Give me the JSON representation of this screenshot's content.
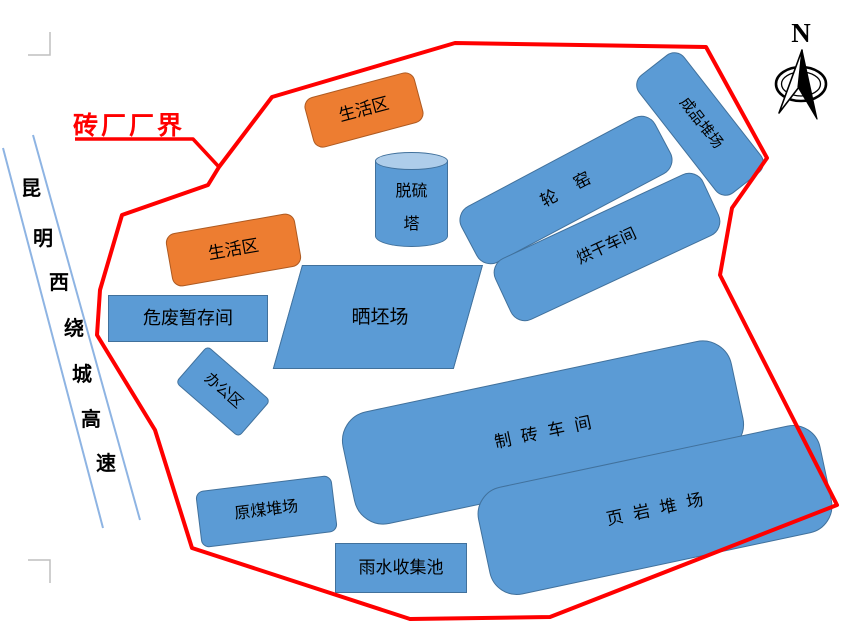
{
  "page": {
    "title_label": "砖厂厂界"
  },
  "compass": {
    "north_label": "N"
  },
  "road": {
    "name": "昆明西绕城高速",
    "chars": [
      "昆",
      "明",
      "西",
      "绕",
      "城",
      "高",
      "速"
    ]
  },
  "areas": {
    "living_area_top": {
      "label": "生活区"
    },
    "living_area_left": {
      "label": "生活区"
    },
    "desulfurization_tower": {
      "line1": "脱硫",
      "line2": "塔"
    },
    "ring_kiln": {
      "label": "轮窑"
    },
    "finished_goods_yard": {
      "label": "成品堆场"
    },
    "drying_workshop": {
      "label": "烘干车间"
    },
    "hazardous_waste_room": {
      "label": "危废暂存间"
    },
    "brick_blank_drying_field": {
      "label": "晒坯场"
    },
    "office_area": {
      "label": "办公区"
    },
    "brick_making_workshop": {
      "label": "制砖车间"
    },
    "shale_yard": {
      "label": "页岩堆场"
    },
    "raw_coal_yard": {
      "label": "原煤堆场"
    },
    "rainwater_collection_pool": {
      "label": "雨水收集池"
    }
  },
  "colors": {
    "boundary_red": "#FF0000",
    "building_blue": "#5B9BD5",
    "building_blue_border": "#41719C",
    "living_orange": "#ED7D31",
    "living_orange_border": "#AE5A21",
    "road_line_blue": "#8EB4E3",
    "cylinder_top_blue": "#AECDEA"
  }
}
